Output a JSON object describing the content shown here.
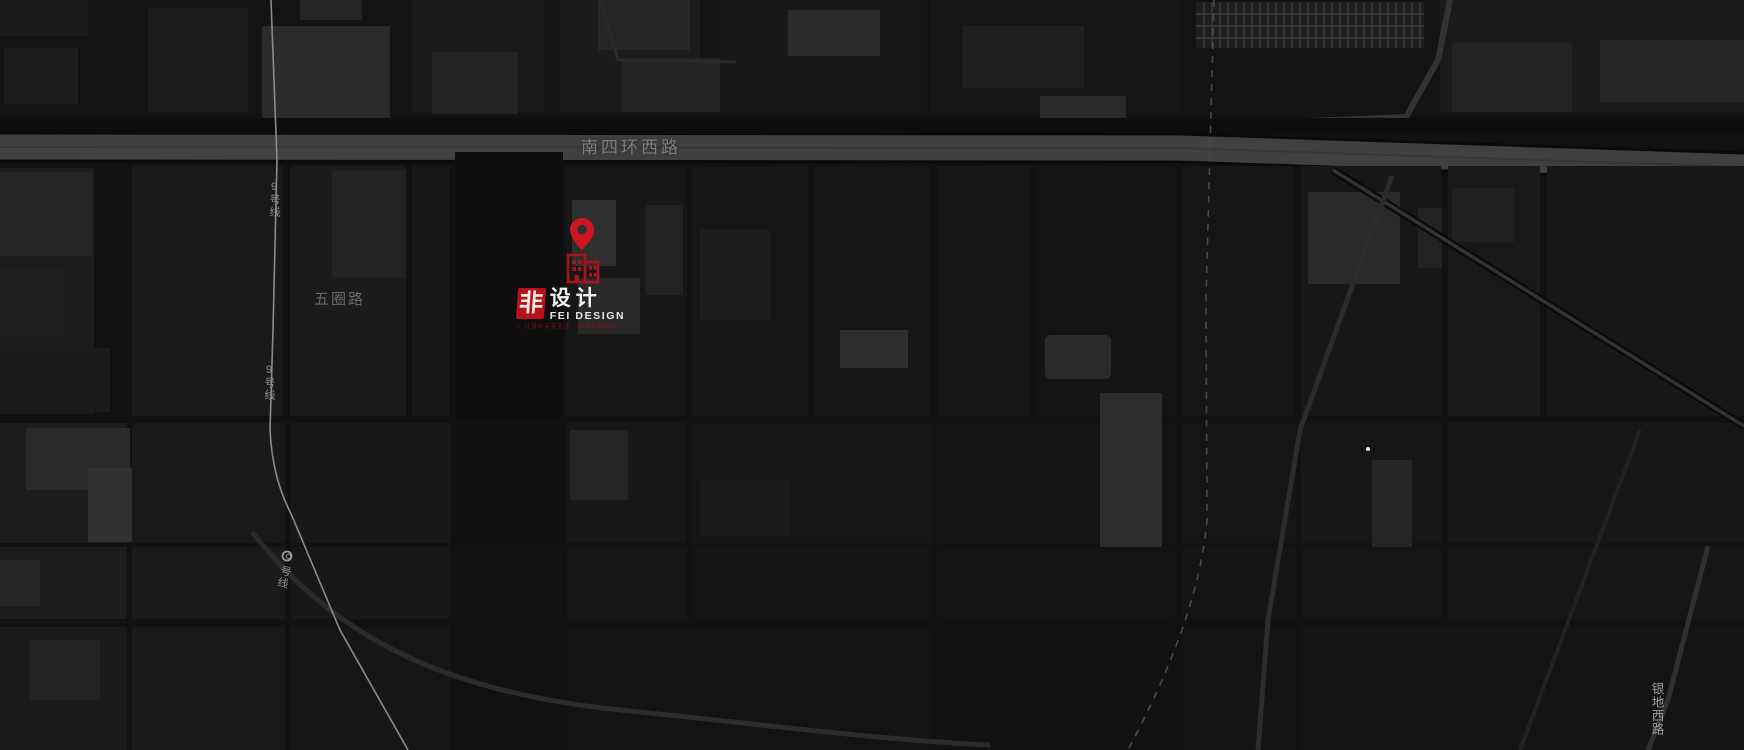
{
  "map": {
    "labels": {
      "ring_road": "南四环西路",
      "wuquan_road": "五圈路",
      "metro_line_9": "9号线",
      "yindi_road": "银地西路"
    },
    "colors": {
      "background": "#121212",
      "highway_band": "#3f3f3f",
      "pin_red": "#d01522",
      "building_red": "#a8141b",
      "logo_red": "#b5121b",
      "tagline_red": "#8c1016"
    }
  },
  "logo": {
    "square_char": "非",
    "cn": "设计",
    "en": "FEI DESIGN",
    "tagline": "— 让设计点亮生活 · 成就美好空间 —"
  }
}
